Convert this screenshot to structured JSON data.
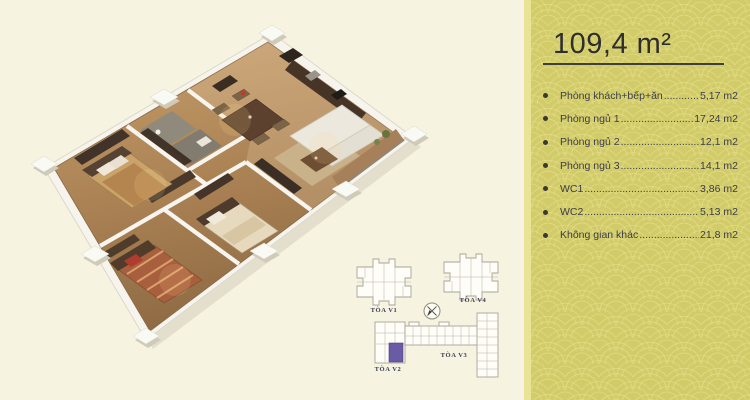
{
  "page": {
    "background_color": "#f7f3e1"
  },
  "info_panel": {
    "title": "109,4 m²",
    "dot_leader": "........................................................................",
    "items": [
      {
        "label": "Phòng khách+bếp+ăn",
        "area": "5,17 m2"
      },
      {
        "label": "Phòng ngủ 1",
        "area": "17,24 m2"
      },
      {
        "label": "Phòng ngủ 2",
        "area": "12,1 m2"
      },
      {
        "label": "Phòng ngủ 3",
        "area": "14,1 m2"
      },
      {
        "label": "WC1",
        "area": "3,86 m2"
      },
      {
        "label": "WC2",
        "area": "5,13 m2"
      },
      {
        "label": "Không gian khác",
        "area": "21,8 m2"
      }
    ],
    "colors": {
      "panel_background": "#d2cb69",
      "pattern": "#e6e08c",
      "edge_strip": "#e9e396",
      "text": "#3c3d49",
      "title_text": "#2e2e2e"
    }
  },
  "site_map": {
    "buildings": [
      {
        "name": "TÒA V1"
      },
      {
        "name": "TÒA V4"
      },
      {
        "name": "TÒA V2"
      },
      {
        "name": "TÒA V3"
      }
    ],
    "unit_highlight_color": "#6a5ba5",
    "label_color": "#373a54"
  },
  "floorplan": {
    "colors": {
      "floor_wood": "#b08a5c",
      "walls": "#f6f4ed",
      "accent_dark": "#46342a"
    }
  }
}
